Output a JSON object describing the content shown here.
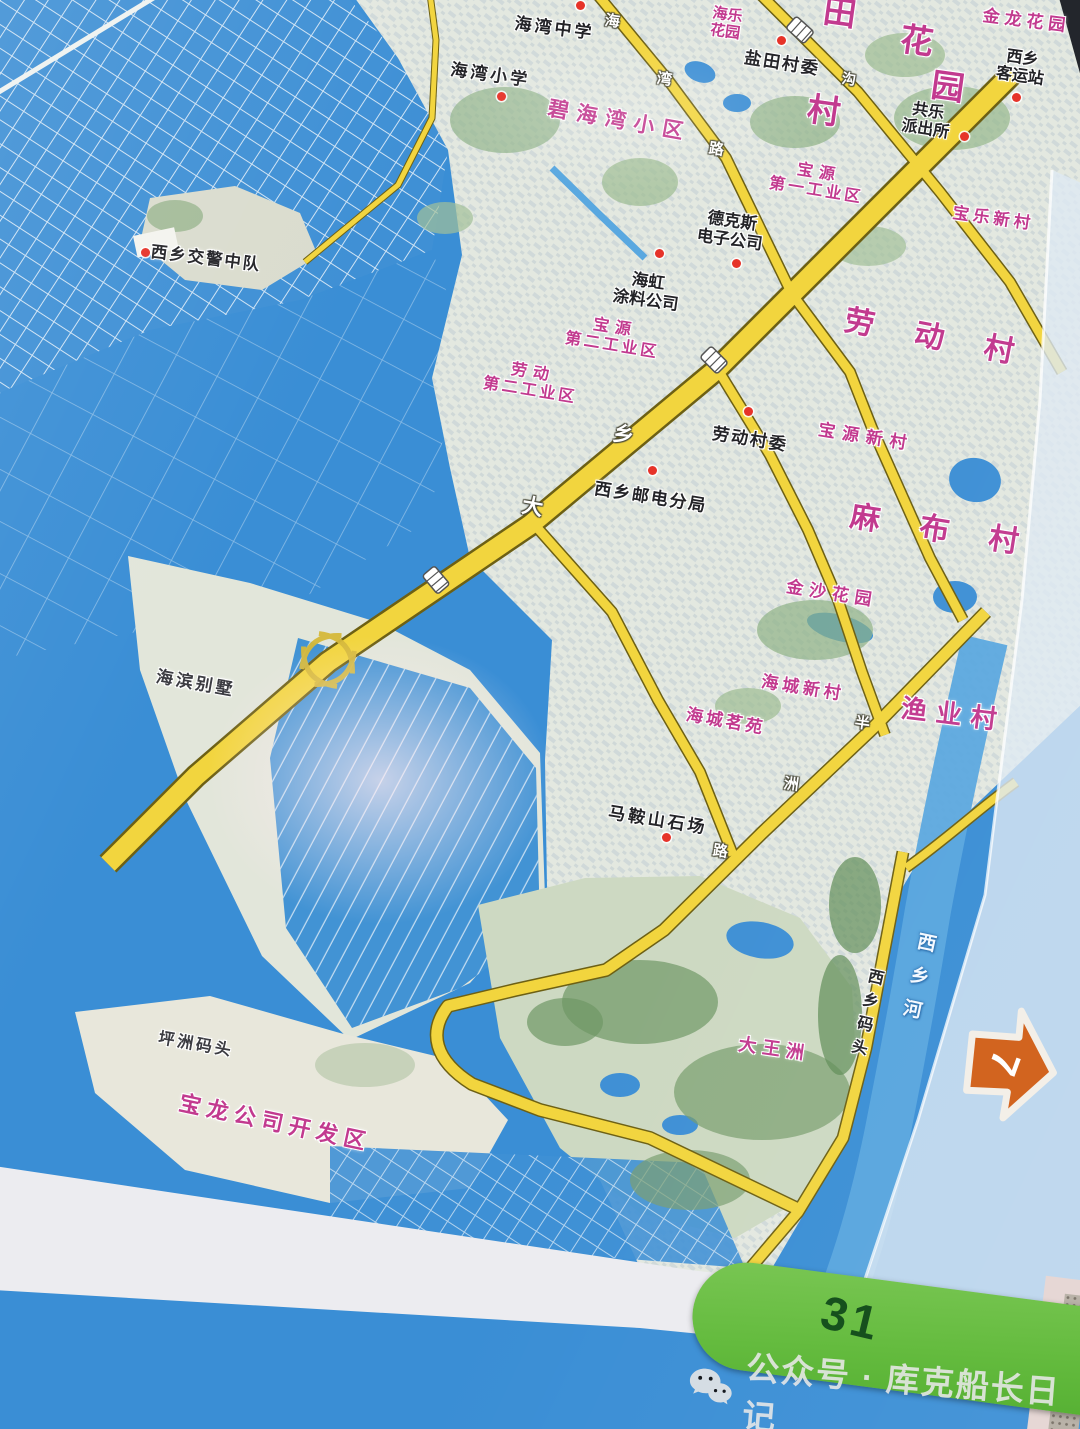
{
  "page": {
    "number": "31",
    "continuation_arrow": "7"
  },
  "watermark": {
    "text": "公众号 · 库克船长日记",
    "icon": "wechat-icon"
  },
  "colors": {
    "sea": "#3a8ed5",
    "road_fill": "#f2d53e",
    "area_label_pink": "#c23a8f",
    "poi_label_black": "#232327",
    "page_tab_green": "#67bd45",
    "arrow_orange": "#d2641f",
    "poi_dot_red": "#e63329"
  },
  "map": {
    "poi": {
      "haiwan_middle_school": "海湾中学",
      "haiwan_primary_school": "海湾小学",
      "yantian_committee": "盐田村委",
      "gongle_l1": "共乐",
      "gongle_l2": "派出所",
      "keyunzhan_l1": "西乡",
      "keyunzhan_l2": "客运站",
      "dekesi_l1": "德克斯",
      "dekesi_l2": "电子公司",
      "haihong_l1": "海虹",
      "haihong_l2": "涂料公司",
      "jiaojing": "西乡交警中队",
      "youdian": "西乡邮电分局",
      "laodong_committee": "劳动村委",
      "maanshan": "马鞍山石场",
      "haibin_villa": "海滨别墅",
      "pingzhou_wharf": "坪洲码头",
      "xixiang_wharf": "西乡码头"
    },
    "areas": {
      "bihaiwan": "碧海湾小区",
      "haile_l1": "海乐",
      "haile_l2": "花园",
      "jinlong": "金龙花园",
      "baoyuan1_l1": "宝源",
      "baoyuan1_l2": "第一工业区",
      "baole": "宝乐新村",
      "baoyuan2_l1": "宝源",
      "baoyuan2_l2": "第二工业区",
      "laodong2_l1": "劳动",
      "laodong2_l2": "第二工业区",
      "baoyuan_xincun": "宝源新村",
      "laodong_village": "劳动村",
      "mabu_village": "麻布村",
      "jinsha": "金沙花园",
      "haicheng_xincun": "海城新村",
      "haicheng_mingyuan": "海城茗苑",
      "yuye_village": "渔业村",
      "dawangzhou": "大王洲",
      "baolong": "宝龙公司开发区",
      "frag_tian": "田",
      "frag_cun": "村",
      "frag_hua": "花",
      "frag_yuan": "园"
    },
    "road_chars": {
      "hai": "海",
      "wan": "湾",
      "lu": "路",
      "xiang": "乡",
      "da": "大",
      "ban": "半",
      "zhou": "洲",
      "lu2": "路",
      "gou": "沟"
    },
    "river_label": "西乡河"
  }
}
